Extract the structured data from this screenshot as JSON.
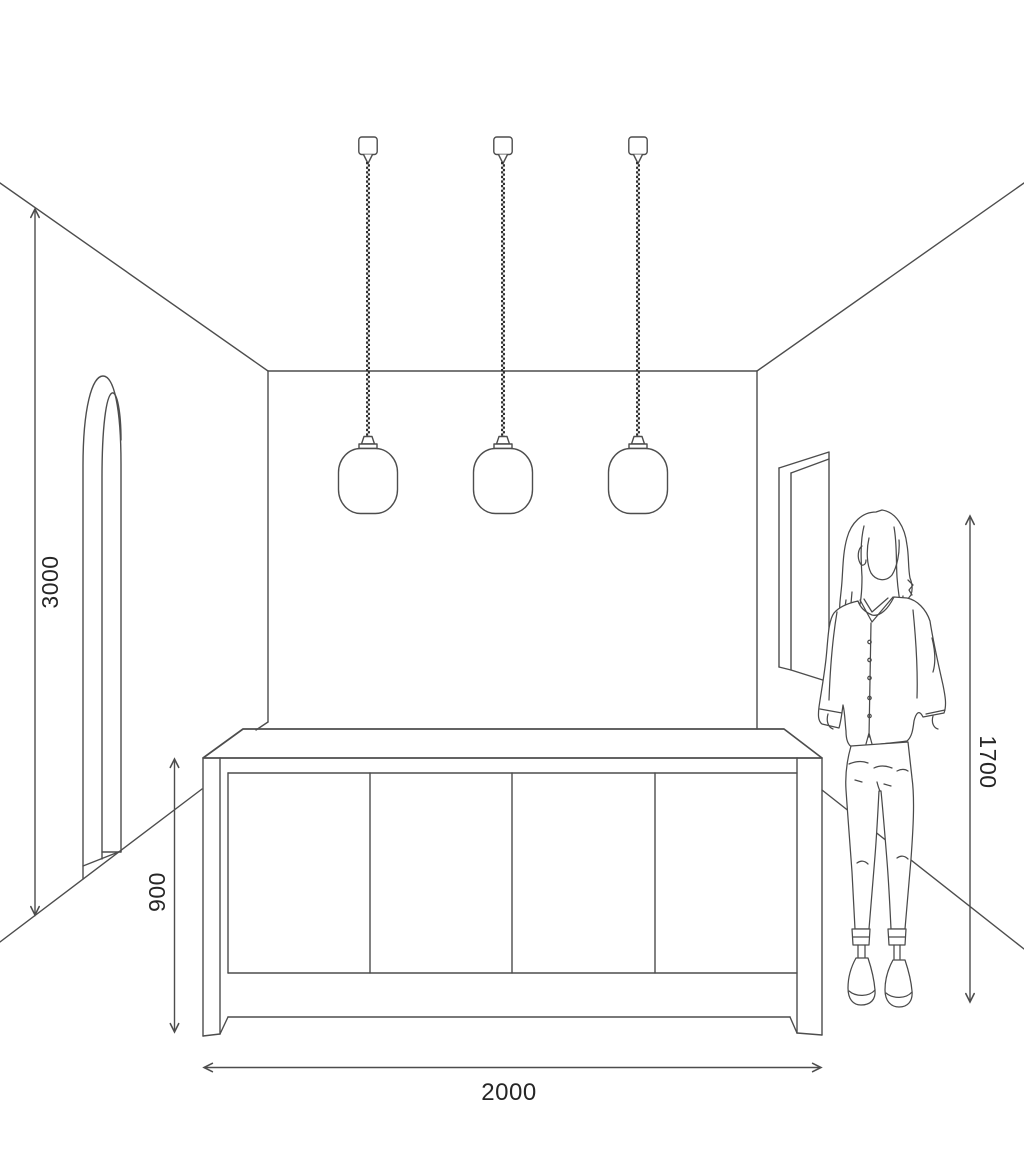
{
  "page": {
    "background": "#ffffff",
    "type": "room-scale-diagram"
  },
  "style": {
    "line_color": "#4d4d4d",
    "cord_color": "#2b2b2b",
    "text_color": "#262626"
  },
  "dimensions": {
    "room_height": {
      "label": "3000",
      "position": "left-wall",
      "orientation": "vertical"
    },
    "island_height": {
      "label": "900",
      "position": "left-of-island",
      "orientation": "vertical"
    },
    "island_width": {
      "label": "2000",
      "position": "below-island",
      "orientation": "horizontal"
    },
    "person_height": {
      "label": "1700",
      "position": "right-of-person",
      "orientation": "vertical"
    }
  },
  "scene": {
    "pendant_lights": {
      "count": 3,
      "parts": [
        "ceiling-canopy",
        "braided-cord",
        "socket",
        "rounded-glass-shade"
      ]
    },
    "kitchen_island": {
      "door_panels": 4
    },
    "person": "standing figure, hands in pockets",
    "left_wall": "arched doorway",
    "right_wall": "rectangular wall frame"
  }
}
